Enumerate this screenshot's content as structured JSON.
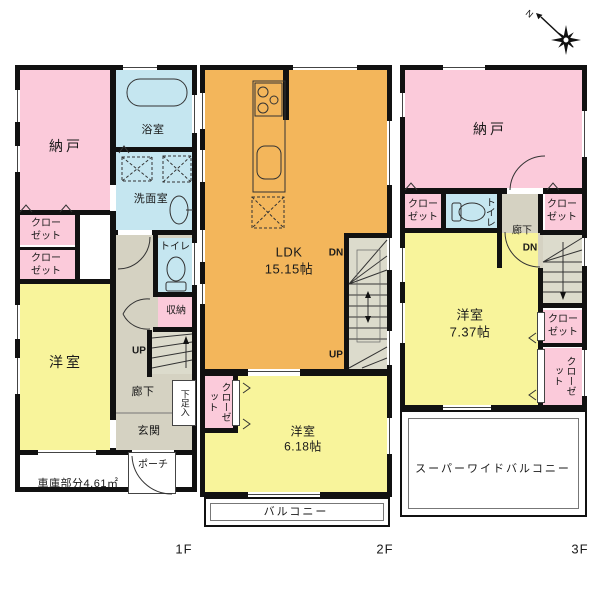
{
  "compass": {
    "north_label": "N"
  },
  "colors": {
    "wall": "#111111",
    "room_pink": "#FBCADA",
    "room_yellow": "#F8F49B",
    "room_orange": "#F3B65B",
    "room_blue": "#C5E6F0",
    "corridor_gray": "#D5D2C2",
    "stairs_gray": "#DCDBCC"
  },
  "floors": {
    "f1": {
      "label": "1F",
      "nando": "納戸",
      "bath": "浴室",
      "washroom": "洗面室",
      "closet_a": "クロー\nゼット",
      "closet_b": "クロー\nゼット",
      "toilet": "トイレ",
      "storage": "収納",
      "western_room": "洋室",
      "up": "UP",
      "corridor": "廊下",
      "shoe_box": "下足入",
      "entrance": "玄関",
      "porch": "ポーチ",
      "garage": "車庫部分4.61㎡"
    },
    "f2": {
      "label": "2F",
      "ldk": "LDK\n15.15帖",
      "dn": "DN",
      "up": "UP",
      "closet": "クローゼット",
      "western_room": "洋室\n6.18帖",
      "balcony": "バルコニー"
    },
    "f3": {
      "label": "3F",
      "nando": "納戸",
      "closet_a": "クロー\nゼット",
      "toilet": "トイレ",
      "corridor": "廊下",
      "dn": "DN",
      "closet_b": "クロー\nゼット",
      "western_room": "洋室\n7.37帖",
      "closet_c": "クロー\nゼット",
      "closet_d": "クローゼット",
      "balcony": "スーパーワイドバルコニー"
    }
  }
}
